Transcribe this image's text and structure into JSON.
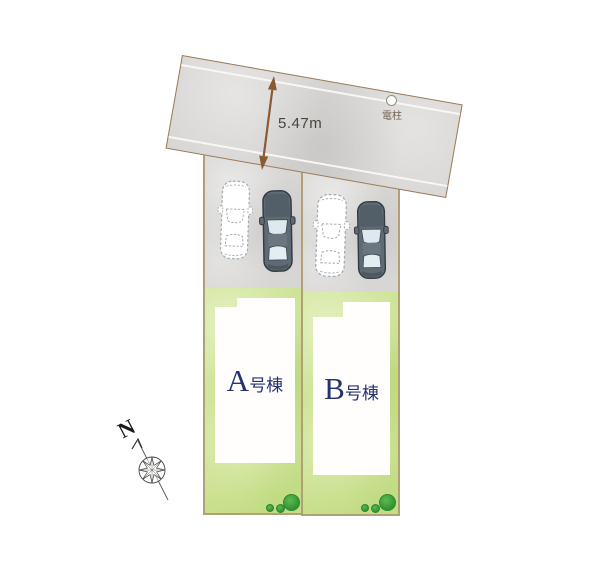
{
  "plan": {
    "road": {
      "width_label": "5.47m",
      "pole_label": "電柱"
    },
    "lots": [
      {
        "id": "A",
        "letter": "A",
        "suffix": "号棟"
      },
      {
        "id": "B",
        "letter": "B",
        "suffix": "号棟"
      }
    ],
    "compass": {
      "north": "N"
    },
    "icons": {
      "car_solid": "car-top-view-solid-icon",
      "car_ghost": "car-top-view-dashed-icon",
      "pole": "utility-pole-icon",
      "tree": "shrub-icon",
      "compass": "compass-rose-icon",
      "dimension_arrow": "dimension-arrow-icon"
    },
    "colors": {
      "road": "#d5d4d2",
      "parking": "#d7d6d4",
      "grass": "#cce293",
      "boundary": "#b1a077",
      "arrow_brown": "#8a5a33",
      "label_navy": "#243271",
      "tree_green": "#3fa33f"
    }
  }
}
